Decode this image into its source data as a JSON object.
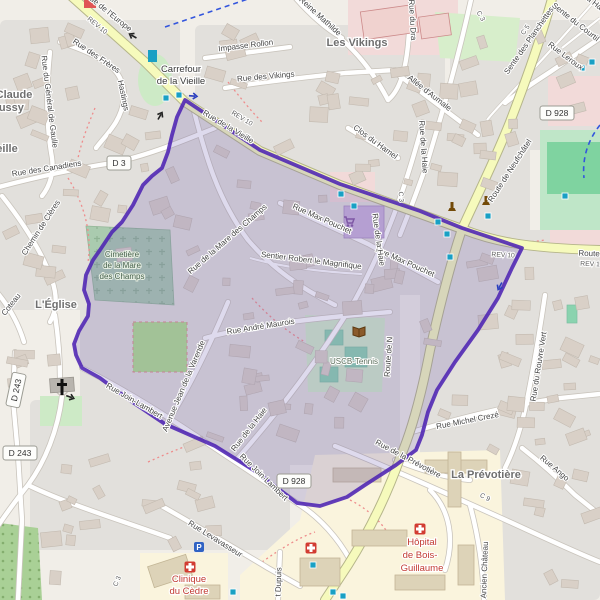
{
  "map": {
    "colors": {
      "land": "#f1eee8",
      "residential": "#e2e0dc",
      "road_fill": "#ffffff",
      "road_casing": "#c9c4bc",
      "major_fill": "#f6fabc",
      "major_casing": "#b5b58a",
      "overlay_stroke": "#4d23b3",
      "overlay_fill": "#7666b4",
      "cemetery": "#aacbaf",
      "park": "#cdeac6",
      "pitch": "#8ad3af",
      "field": "#7fd3a0",
      "grass": "#b0e08e",
      "forest": "#a9d096",
      "hospital_zone": "#faf4dd",
      "commercial": "#f2dad9",
      "retail_building": "#c9b2dc",
      "building": "#d9d0c7",
      "signal": "#19a0c4",
      "cycle": "#3355dd",
      "footpath": "#ee8c8c",
      "hospital_red": "#d23c32"
    },
    "street_labels": [
      {
        "t": "Rue de l'Europe",
        "x": 107,
        "y": 14,
        "r": 39
      },
      {
        "t": "REV 10",
        "x": 96,
        "y": 27,
        "r": 39,
        "c": "rev"
      },
      {
        "t": "Impasse Rollon",
        "x": 246,
        "y": 48,
        "r": -7
      },
      {
        "t": "Rue des Vikings",
        "x": 266,
        "y": 79,
        "r": -5
      },
      {
        "t": "a Reine Mathilde",
        "x": 316,
        "y": 16,
        "r": 42
      },
      {
        "t": "Rue du Dra",
        "x": 410,
        "y": 20,
        "r": 87
      },
      {
        "t": "C 3",
        "x": 479,
        "y": 17,
        "r": 60,
        "c": "rev"
      },
      {
        "t": "Sente des Planchettes",
        "x": 531,
        "y": 42,
        "r": -55
      },
      {
        "t": "Sente du Courtil",
        "x": 574,
        "y": 24,
        "r": 38
      },
      {
        "t": "a Ha",
        "x": 593,
        "y": 5,
        "r": 38
      },
      {
        "t": "Rue Leroux",
        "x": 564,
        "y": 58,
        "r": 37
      },
      {
        "t": "C 5",
        "x": 527,
        "y": 31,
        "r": -55,
        "c": "rev"
      },
      {
        "t": "Allée d'Aumale",
        "x": 428,
        "y": 95,
        "r": 38
      },
      {
        "t": "Clos du Hamel",
        "x": 374,
        "y": 144,
        "r": 36
      },
      {
        "t": "Rue de la Haie",
        "x": 421,
        "y": 147,
        "r": 86
      },
      {
        "t": "C 3",
        "x": 399,
        "y": 197,
        "r": 86,
        "c": "rev"
      },
      {
        "t": "Rue de la Vieille",
        "x": 227,
        "y": 129,
        "r": 31
      },
      {
        "t": "REV 10",
        "x": 241,
        "y": 120,
        "r": 31,
        "c": "rev"
      },
      {
        "t": "Route de Neufchâtel",
        "x": 512,
        "y": 172,
        "r": -57
      },
      {
        "t": "Rue des Canadiens",
        "x": 47,
        "y": 171,
        "r": -9
      },
      {
        "t": "Chemin de Clères",
        "x": 43,
        "y": 229,
        "r": -57
      },
      {
        "t": "Rue du Général de Gaulle",
        "x": 47,
        "y": 102,
        "r": 83
      },
      {
        "t": "Rue des Frères",
        "x": 95,
        "y": 58,
        "r": 34
      },
      {
        "t": "Hastings",
        "x": 121,
        "y": 96,
        "r": 78
      },
      {
        "t": "Rue de la Mare des Champs",
        "x": 229,
        "y": 241,
        "r": -41
      },
      {
        "t": "Rue Max Pouchet",
        "x": 321,
        "y": 221,
        "r": 24
      },
      {
        "t": "Rue Max Pouchet",
        "x": 404,
        "y": 264,
        "r": 24
      },
      {
        "t": "Sentier Robert le Magnifique",
        "x": 311,
        "y": 263,
        "r": 7
      },
      {
        "t": "Rue de la Haie",
        "x": 376,
        "y": 240,
        "r": 82
      },
      {
        "t": "Coteau",
        "x": 13,
        "y": 306,
        "r": -52
      },
      {
        "t": "Rue André Maurois",
        "x": 261,
        "y": 329,
        "r": -9
      },
      {
        "t": "Avenue Jean de la Varende",
        "x": 186,
        "y": 387,
        "r": -67
      },
      {
        "t": "Rue Join-Lambert",
        "x": 133,
        "y": 403,
        "r": 30
      },
      {
        "t": "Rue Join-Lambert",
        "x": 262,
        "y": 479,
        "r": 44
      },
      {
        "t": "Rue de la Haie",
        "x": 251,
        "y": 431,
        "r": -52
      },
      {
        "t": "Route de N",
        "x": 391,
        "y": 357,
        "r": -86
      },
      {
        "t": "REV 10",
        "x": 503,
        "y": 257,
        "r": 3,
        "c": "rev"
      },
      {
        "t": "Route",
        "x": 589,
        "y": 256,
        "r": 2
      },
      {
        "t": "REV 1",
        "x": 590,
        "y": 266,
        "r": 2,
        "c": "rev"
      },
      {
        "t": "Rue Michel Crezé",
        "x": 468,
        "y": 423,
        "r": -11
      },
      {
        "t": "Rue du Rouvre Vert",
        "x": 541,
        "y": 367,
        "r": -81
      },
      {
        "t": "Rue Ango",
        "x": 553,
        "y": 470,
        "r": 40
      },
      {
        "t": "Rue de la Prévotière",
        "x": 407,
        "y": 461,
        "r": 28
      },
      {
        "t": "C 9",
        "x": 484,
        "y": 499,
        "r": 28,
        "c": "rev"
      },
      {
        "t": "Ancien Château",
        "x": 487,
        "y": 570,
        "r": -88
      },
      {
        "t": "Rue Levavasseur",
        "x": 214,
        "y": 541,
        "r": 32
      },
      {
        "t": "C 3",
        "x": 119,
        "y": 582,
        "r": -68,
        "c": "rev"
      },
      {
        "t": "t Dupuis",
        "x": 281,
        "y": 582,
        "r": -88
      }
    ],
    "place_labels": [
      {
        "t": "Carrefour",
        "x": 181,
        "y": 72,
        "c": "pl2"
      },
      {
        "t": "de la Vieille",
        "x": 181,
        "y": 84,
        "c": "pl2"
      },
      {
        "t": "Les Vikings",
        "x": 357,
        "y": 46,
        "c": "pl"
      },
      {
        "t": "L'Église",
        "x": 56,
        "y": 308,
        "c": "pl"
      },
      {
        "t": "La Prévotière",
        "x": 486,
        "y": 478,
        "c": "pl"
      },
      {
        "t": "Claude",
        "x": 14,
        "y": 98,
        "c": "pl"
      },
      {
        "t": "bussy",
        "x": 8,
        "y": 111,
        "c": "pl"
      },
      {
        "t": "eille",
        "x": 7,
        "y": 152,
        "c": "pl"
      }
    ],
    "area_labels": [
      {
        "t": "Cimetière",
        "x": 122,
        "y": 257,
        "c": "cem"
      },
      {
        "t": "de la Mare",
        "x": 122,
        "y": 268,
        "c": "cem"
      },
      {
        "t": "des Champs",
        "x": 122,
        "y": 279,
        "c": "cem"
      },
      {
        "t": "USCB-Tennis",
        "x": 354,
        "y": 364,
        "c": "leis"
      },
      {
        "t": "Hôpital",
        "x": 422,
        "y": 545,
        "c": "hosp"
      },
      {
        "t": "de Bois-",
        "x": 420,
        "y": 558,
        "c": "hosp"
      },
      {
        "t": "Guillaume",
        "x": 422,
        "y": 571,
        "c": "hosp"
      },
      {
        "t": "Clinique",
        "x": 189,
        "y": 582,
        "c": "hosp"
      },
      {
        "t": "du Cèdre",
        "x": 189,
        "y": 594,
        "c": "hosp"
      }
    ],
    "shields": [
      {
        "t": "D 928",
        "x": 557,
        "y": 113,
        "r": 0
      },
      {
        "t": "D 3",
        "x": 119,
        "y": 163,
        "r": 0
      },
      {
        "t": "D 243",
        "x": 20,
        "y": 453,
        "r": 0
      },
      {
        "t": "D 928",
        "x": 294,
        "y": 481,
        "r": 0
      },
      {
        "t": "D 243",
        "x": 16,
        "y": 390,
        "r": -78
      }
    ],
    "icons": [
      {
        "name": "church-icon",
        "x": 62,
        "y": 387
      },
      {
        "name": "hospital-icon",
        "x": 420,
        "y": 529
      },
      {
        "name": "hospital-icon",
        "x": 190,
        "y": 567
      },
      {
        "name": "hospital-icon",
        "x": 311,
        "y": 548
      },
      {
        "name": "parking-icon",
        "x": 199,
        "y": 547
      },
      {
        "name": "library-icon",
        "x": 359,
        "y": 331
      },
      {
        "name": "monument-icon",
        "x": 452,
        "y": 207
      },
      {
        "name": "monument-icon",
        "x": 486,
        "y": 201
      },
      {
        "name": "supermarket-icon",
        "x": 349,
        "y": 221
      }
    ],
    "traffic_signals": [
      [
        152,
        56
      ],
      [
        166,
        98
      ],
      [
        179,
        95
      ],
      [
        341,
        194
      ],
      [
        354,
        206
      ],
      [
        438,
        222
      ],
      [
        447,
        234
      ],
      [
        450,
        257
      ],
      [
        488,
        216
      ],
      [
        565,
        196
      ],
      [
        582,
        68
      ],
      [
        592,
        62
      ],
      [
        313,
        565
      ],
      [
        343,
        596
      ],
      [
        233,
        592
      ],
      [
        333,
        592
      ]
    ],
    "oneway_arrows": [
      {
        "x": 133,
        "y": 36,
        "r": 210,
        "c": "#222222"
      },
      {
        "x": 160,
        "y": 116,
        "r": -60,
        "c": "#222222"
      },
      {
        "x": 70,
        "y": 397,
        "r": 20,
        "c": "#222222"
      },
      {
        "x": 193,
        "y": 96,
        "r": 5,
        "c": "#2b3fbf"
      },
      {
        "x": 500,
        "y": 286,
        "r": 118,
        "c": "#2b3fbf"
      }
    ],
    "route_overlay": {
      "points": [
        [
          185,
          100
        ],
        [
          260,
          150
        ],
        [
          340,
          184
        ],
        [
          420,
          211
        ],
        [
          462,
          228
        ],
        [
          522,
          248
        ],
        [
          512,
          268
        ],
        [
          498,
          298
        ],
        [
          478,
          330
        ],
        [
          455,
          362
        ],
        [
          437,
          390
        ],
        [
          428,
          412
        ],
        [
          422,
          435
        ],
        [
          416,
          450
        ],
        [
          396,
          465
        ],
        [
          365,
          485
        ],
        [
          347,
          497
        ],
        [
          320,
          506
        ],
        [
          297,
          503
        ],
        [
          255,
          471
        ],
        [
          215,
          446
        ],
        [
          165,
          424
        ],
        [
          128,
          399
        ],
        [
          100,
          378
        ],
        [
          82,
          368
        ],
        [
          76,
          355
        ],
        [
          74,
          344
        ],
        [
          79,
          331
        ],
        [
          88,
          316
        ],
        [
          89,
          304
        ],
        [
          84,
          290
        ],
        [
          86,
          275
        ],
        [
          93,
          260
        ],
        [
          100,
          250
        ],
        [
          112,
          232
        ],
        [
          122,
          222
        ],
        [
          133,
          205
        ],
        [
          143,
          185
        ],
        [
          152,
          176
        ],
        [
          162,
          168
        ],
        [
          168,
          152
        ],
        [
          172,
          135
        ],
        [
          177,
          117
        ],
        [
          185,
          100
        ]
      ]
    }
  }
}
